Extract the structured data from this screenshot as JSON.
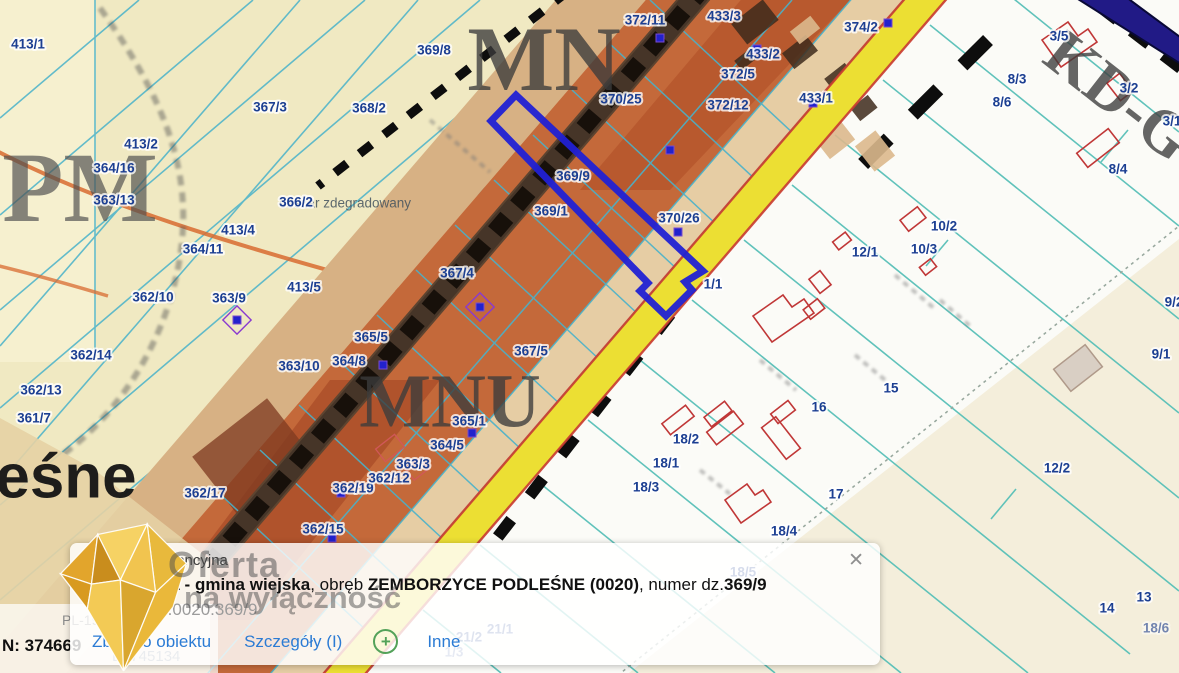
{
  "map": {
    "highlight_parcel": "369/9",
    "colors": {
      "cream_zone": "#f0e9c2",
      "tan_strip": "#d7b184",
      "orange_zone": "#c4693a",
      "beige_strip": "#e6cda4",
      "yellow_road": "#ecdf33",
      "navy_road": "#211a86",
      "highlight_blue": "#2121d4",
      "parcel_line_cyan": "#49b2ca",
      "parcel_line_teal": "#58c0b8",
      "label_blue": "#1c3f92",
      "building_red": "#c03737"
    },
    "labels": [
      {
        "t": "obszar zdegradowany",
        "x": 345,
        "y": 203,
        "s": 13.5,
        "c": "#43525e",
        "o": 0.85,
        "h": 0,
        "w": "normal",
        "n": "degraded-area-label"
      },
      {
        "t": "PM",
        "x": 80,
        "y": 186,
        "s": 100,
        "f": 1,
        "c": "#4f4f4f",
        "o": 0.68,
        "h": 0,
        "n": "zone-label-pm"
      },
      {
        "t": "MN",
        "x": 544,
        "y": 58,
        "s": 92,
        "f": 1,
        "c": "#3c3c3c",
        "o": 0.78,
        "h": 0,
        "n": "zone-label-mn"
      },
      {
        "t": "MNU",
        "x": 450,
        "y": 400,
        "s": 76,
        "f": 1,
        "c": "#3c3c3c",
        "o": 0.78,
        "h": 0,
        "n": "zone-label-mnu"
      },
      {
        "t": "KD-G",
        "x": 1120,
        "y": 95,
        "s": 64,
        "f": 1,
        "c": "#3c3c3c",
        "o": 0.78,
        "h": 0,
        "r": 38,
        "n": "zone-label-kdg"
      },
      {
        "t": "eśne",
        "x": 66,
        "y": 476,
        "s": 62,
        "c": "#141414",
        "o": 0.95,
        "h": 0,
        "n": "place-name-fragment"
      },
      {
        "t": "413/1",
        "x": 28,
        "y": 44
      },
      {
        "t": "367/3",
        "x": 270,
        "y": 107
      },
      {
        "t": "368/2",
        "x": 369,
        "y": 108
      },
      {
        "t": "369/8",
        "x": 434,
        "y": 50
      },
      {
        "t": "413/2",
        "x": 141,
        "y": 144
      },
      {
        "t": "364/16",
        "x": 114,
        "y": 168
      },
      {
        "t": "363/13",
        "x": 114,
        "y": 200
      },
      {
        "t": "413/4",
        "x": 238,
        "y": 230
      },
      {
        "t": "364/11",
        "x": 203,
        "y": 249
      },
      {
        "t": "362/10",
        "x": 153,
        "y": 297
      },
      {
        "t": "363/9",
        "x": 229,
        "y": 298
      },
      {
        "t": "413/5",
        "x": 304,
        "y": 287
      },
      {
        "t": "362/14",
        "x": 91,
        "y": 355
      },
      {
        "t": "362/13",
        "x": 41,
        "y": 390
      },
      {
        "t": "361/7",
        "x": 34,
        "y": 418
      },
      {
        "t": "362/17",
        "x": 205,
        "y": 493
      },
      {
        "t": "362/15",
        "x": 323,
        "y": 529
      },
      {
        "t": "362/19",
        "x": 353,
        "y": 488
      },
      {
        "t": "362/12",
        "x": 389,
        "y": 478
      },
      {
        "t": "363/3",
        "x": 413,
        "y": 464
      },
      {
        "t": "364/5",
        "x": 447,
        "y": 445
      },
      {
        "t": "365/1",
        "x": 469,
        "y": 421
      },
      {
        "t": "363/10",
        "x": 299,
        "y": 366
      },
      {
        "t": "364/8",
        "x": 349,
        "y": 361
      },
      {
        "t": "365/5",
        "x": 371,
        "y": 337
      },
      {
        "t": "367/4",
        "x": 457,
        "y": 273
      },
      {
        "t": "367/5",
        "x": 531,
        "y": 351
      },
      {
        "t": "366/2",
        "x": 296,
        "y": 202
      },
      {
        "t": "369/9",
        "x": 573,
        "y": 176
      },
      {
        "t": "369/1",
        "x": 551,
        "y": 211
      },
      {
        "t": "370/26",
        "x": 679,
        "y": 218
      },
      {
        "t": "370/25",
        "x": 621,
        "y": 99
      },
      {
        "t": "372/11",
        "x": 645,
        "y": 20
      },
      {
        "t": "433/3",
        "x": 724,
        "y": 16
      },
      {
        "t": "374/2",
        "x": 861,
        "y": 27
      },
      {
        "t": "433/2",
        "x": 763,
        "y": 54
      },
      {
        "t": "372/5",
        "x": 738,
        "y": 74
      },
      {
        "t": "433/1",
        "x": 816,
        "y": 98
      },
      {
        "t": "372/12",
        "x": 728,
        "y": 105
      },
      {
        "t": "1/1",
        "x": 713,
        "y": 284
      },
      {
        "t": "3/5",
        "x": 1059,
        "y": 36
      },
      {
        "t": "8/3",
        "x": 1017,
        "y": 79
      },
      {
        "t": "8/6",
        "x": 1002,
        "y": 102
      },
      {
        "t": "3/2",
        "x": 1129,
        "y": 88
      },
      {
        "t": "3/1",
        "x": 1172,
        "y": 121
      },
      {
        "t": "8/4",
        "x": 1118,
        "y": 169
      },
      {
        "t": "10/2",
        "x": 944,
        "y": 226
      },
      {
        "t": "10/3",
        "x": 924,
        "y": 249
      },
      {
        "t": "12/1",
        "x": 865,
        "y": 252
      },
      {
        "t": "9/2",
        "x": 1174,
        "y": 302
      },
      {
        "t": "9/1",
        "x": 1161,
        "y": 354
      },
      {
        "t": "15",
        "x": 891,
        "y": 388
      },
      {
        "t": "16",
        "x": 819,
        "y": 407
      },
      {
        "t": "17",
        "x": 836,
        "y": 494
      },
      {
        "t": "18/2",
        "x": 686,
        "y": 439
      },
      {
        "t": "18/1",
        "x": 666,
        "y": 463
      },
      {
        "t": "18/3",
        "x": 646,
        "y": 487
      },
      {
        "t": "18/4",
        "x": 784,
        "y": 531
      },
      {
        "t": "12/2",
        "x": 1057,
        "y": 468
      },
      {
        "t": "13",
        "x": 1144,
        "y": 597
      },
      {
        "t": "14",
        "x": 1107,
        "y": 608
      },
      {
        "t": "18/5",
        "x": 743,
        "y": 572
      },
      {
        "t": "18/6",
        "x": 1156,
        "y": 628,
        "o": 0.6
      },
      {
        "t": "21/1",
        "x": 500,
        "y": 629,
        "o": 0.8
      },
      {
        "t": "21/2",
        "x": 469,
        "y": 637,
        "o": 0.8
      },
      {
        "t": "1/3",
        "x": 454,
        "y": 652,
        "o": 0.6
      }
    ]
  },
  "coords_panel": {
    "crs": "PL-1992",
    "n": "N: 374669",
    "e": "E: 745134"
  },
  "watermark": {
    "line1": "Oferta",
    "line2": "na wyłączność"
  },
  "popup": {
    "title": "Działka ewidencyjna",
    "region_bold": "Konopnica - gmina wiejska",
    "obreb_prefix": ", obręb ",
    "obreb_bold": "ZEMBORZYCE PODLEŚNE (0020)",
    "parcel_prefix": ", numer dz.",
    "parcel_bold": "369/9",
    "identifier": "060908_2.0020.369/9",
    "links": {
      "zoom": "Zbliż do obiektu",
      "details": "Szczegóły (I)",
      "plus": "+",
      "other": "Inne"
    },
    "close": "✕"
  }
}
